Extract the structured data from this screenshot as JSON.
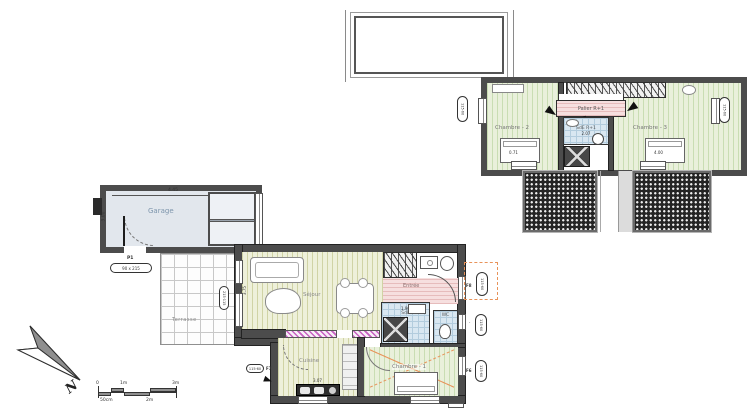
{
  "colors": {
    "wall": "#4c4c4c",
    "bedroom_floor": "#e9f0db",
    "living_floor": "#eef0da",
    "landing_pink": "#f6dfdf",
    "wet_room_blue": "#d9e7f1",
    "garage_fill": "#e2e7ed",
    "roof_hatch": "#242424",
    "attic_dash_orange": "#e8935a",
    "insulation_magenta": "#c55fc0"
  },
  "upper_floor": {
    "chambre2_label": "Chambre - 2",
    "chambre2_dim": "0.71",
    "chambre3_label": "Chambre - 3",
    "chambre3_dim": "4.00",
    "palier_label": "Palier R+1",
    "palier_dim": "3.70",
    "sde_label": "SdE R+1",
    "sde_dim": "2.07",
    "window_tag_left": "115·60",
    "window_tag_right": "115·60"
  },
  "ground_floor": {
    "garage_label": "Garage",
    "garage_width": "4.45",
    "garage_depth": "3.00",
    "door_p1_label": "P1",
    "door_p1_size": "90 x 215",
    "terrasse_label": "Terrasse",
    "terrasse_tag": "215·115",
    "sejour_label": "Séjour",
    "sejour_dim": "3.75",
    "entree_label": "Entrée",
    "sde_label": "SdE",
    "sde_dim": "1.90",
    "wc_label": "WC",
    "cuisine_label": "Cuisine",
    "cuisine_dim": "3.07",
    "chambre1_label": "Chambre - 1",
    "chambre1_dim": "4.15",
    "tag_f8": "F8",
    "tag_f7": "F7",
    "tag_f6": "F6",
    "tag_dot": "·",
    "window_tag": "115·60"
  },
  "compass_label": "N",
  "scale_bar": {
    "zero": "0",
    "one_m": "1m",
    "three_m": "3m",
    "fifty_cm": "50cm",
    "two_m": "2m"
  }
}
